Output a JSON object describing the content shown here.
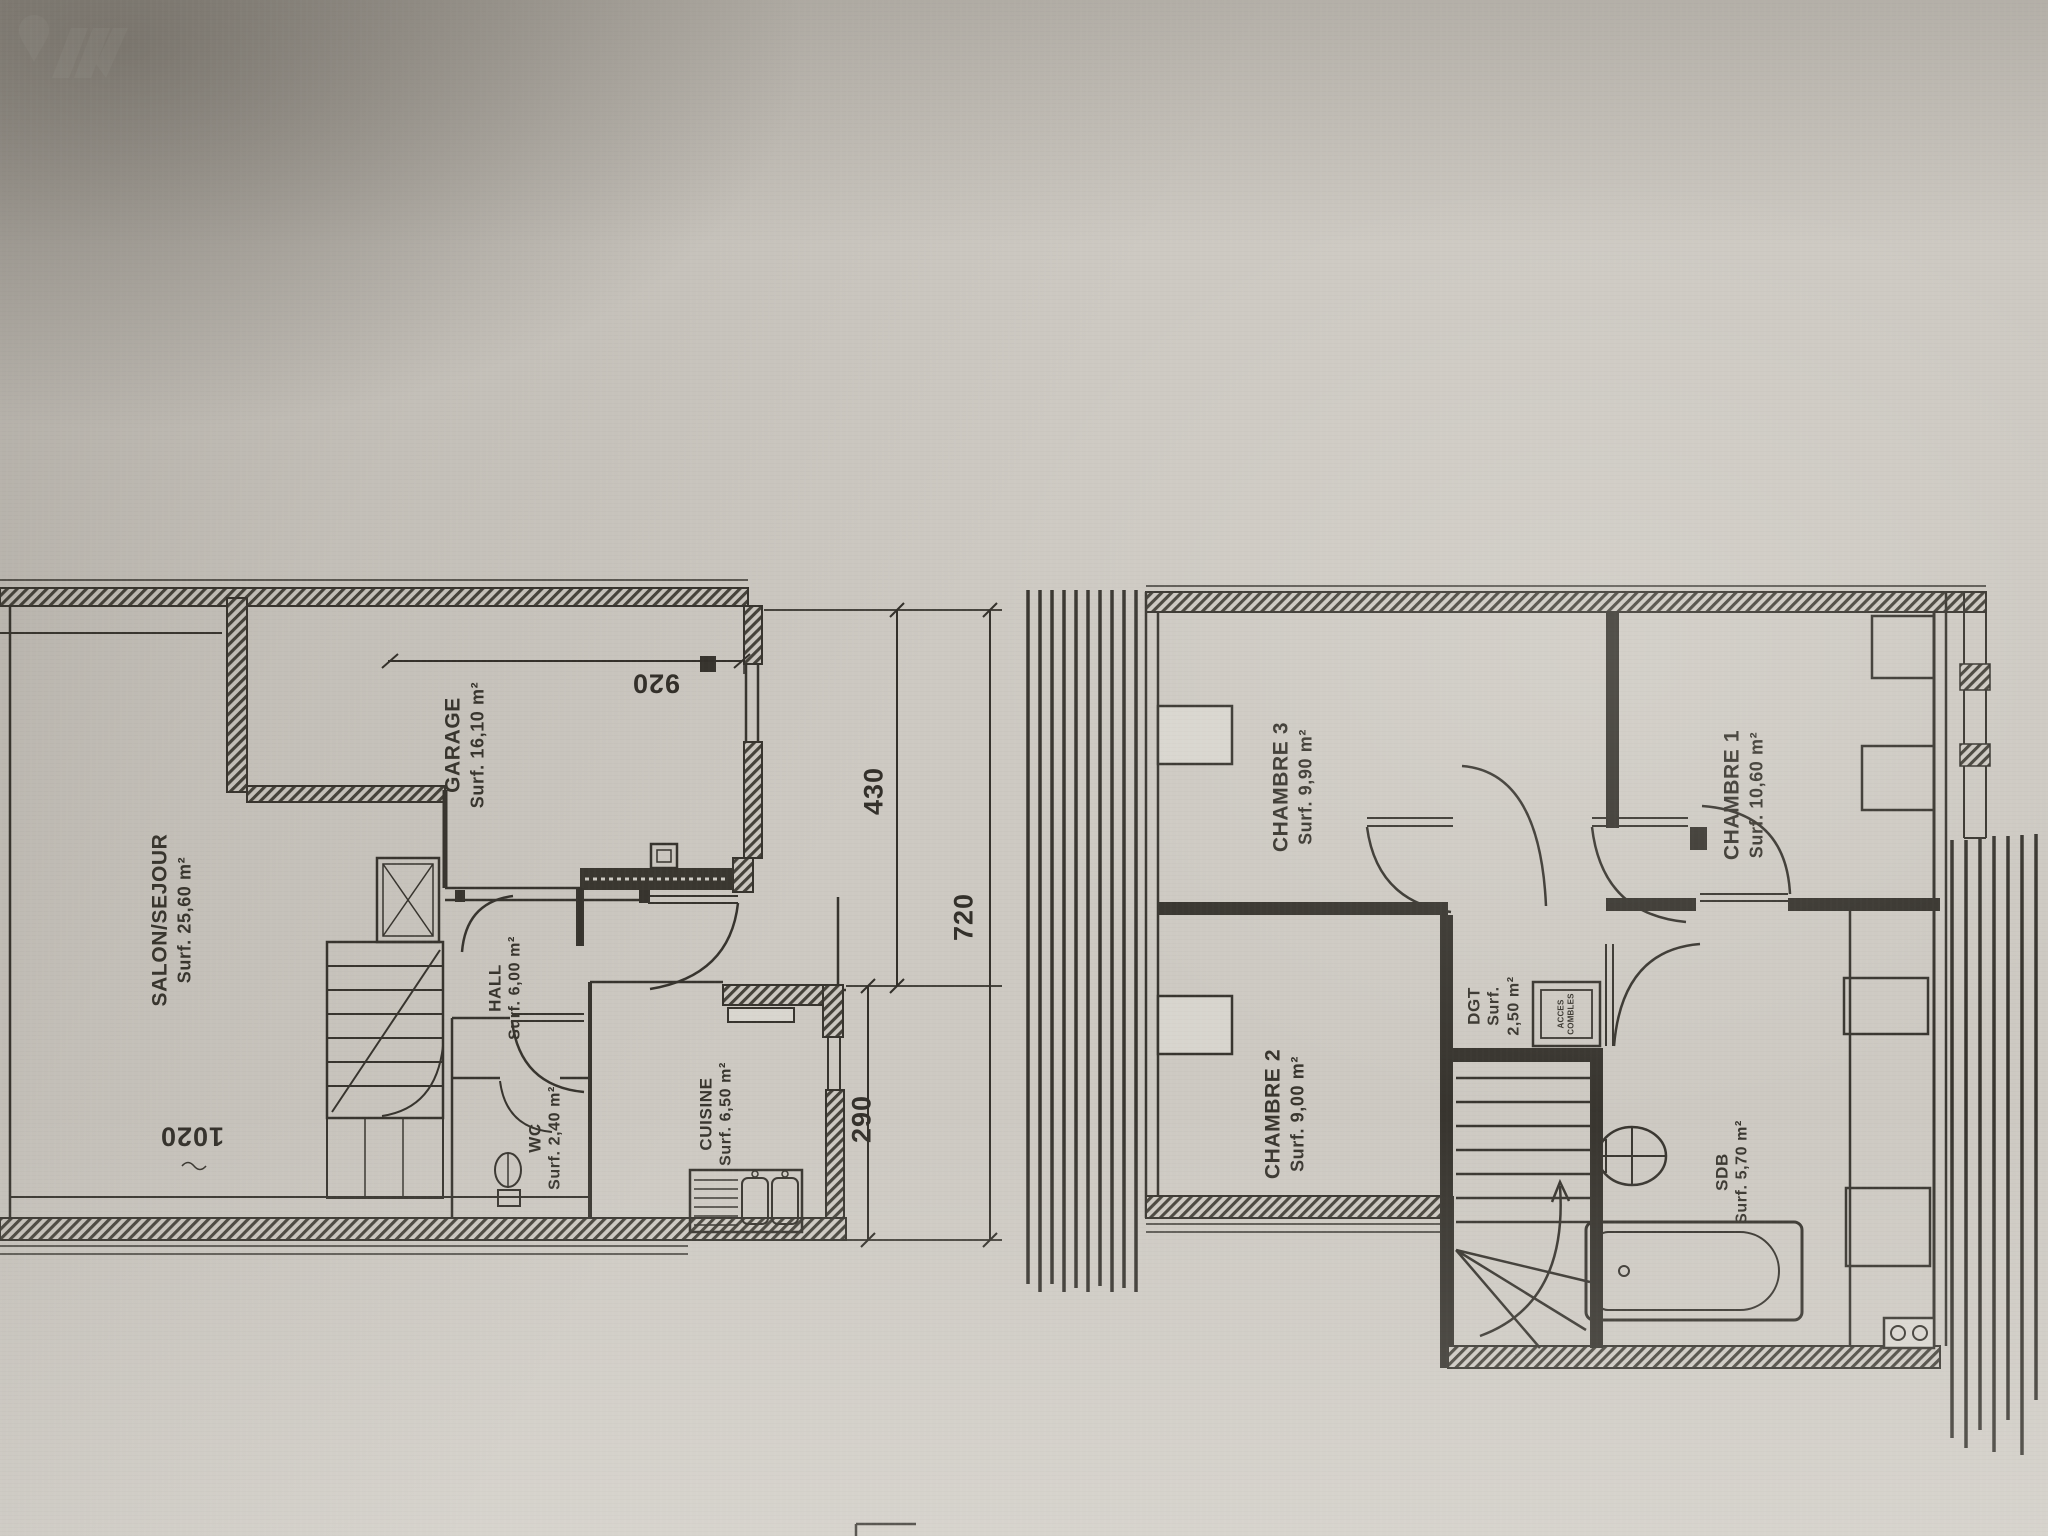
{
  "plan1": {
    "salon": {
      "name": "SALON/SEJOUR",
      "surf": "Surf. 25,60 m²"
    },
    "garage": {
      "name": "GARAGE",
      "surf": "Surf. 16,10 m²"
    },
    "hall": {
      "name": "HALL",
      "surf": "Surf. 6,00 m²"
    },
    "wc": {
      "name": "WC",
      "surf": "Surf. 2,40 m²"
    },
    "cuisine": {
      "name": "CUISINE",
      "surf": "Surf. 6,50 m²"
    }
  },
  "plan2": {
    "chambre3": {
      "name": "CHAMBRE 3",
      "surf": "Surf. 9,90 m²"
    },
    "chambre2": {
      "name": "CHAMBRE 2",
      "surf": "Surf. 9,00 m²"
    },
    "chambre1": {
      "name": "CHAMBRE 1",
      "surf": "Surf. 10,60 m²"
    },
    "dgt": {
      "name": "DGT",
      "surf": "Surf.",
      "area": "2,50 m²"
    },
    "sdb": {
      "name": "SDB",
      "surf": "Surf. 5,70 m²"
    },
    "acces": {
      "line1": "ACCES",
      "line2": "COMBLES"
    }
  },
  "dims": {
    "d920": "920",
    "d1020": "1020",
    "d430": "430",
    "d720": "720",
    "d290": "290"
  }
}
